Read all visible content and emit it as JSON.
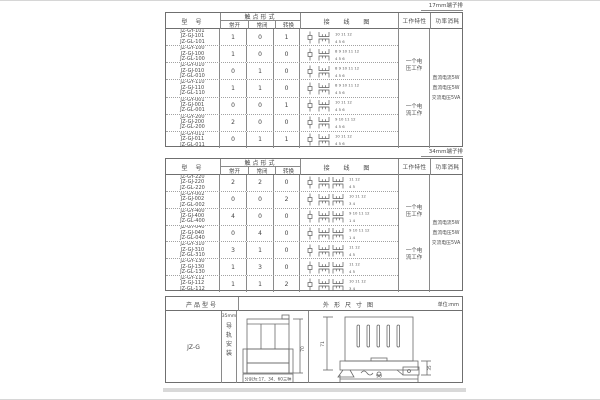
{
  "labels": {
    "t1": "17mm端子排",
    "t2": "34mm端子排"
  },
  "headers": {
    "model": "型 号",
    "contact": "触点形式",
    "no": "常开",
    "nc": "常闭",
    "co": "转换",
    "wiring": "接 线 图",
    "work": "工作特性",
    "power": "功率消耗"
  },
  "common": {
    "work_notes": [
      "一个电压工作",
      "一个电流工作"
    ],
    "power_notes": [
      "直流电流5W",
      "直流电压5W",
      "交流电压5VA"
    ]
  },
  "table1": {
    "rows": [
      {
        "models": [
          "JZ-GY-101",
          "JZ-GJ-101",
          "JZ-GL-101"
        ],
        "no": "1",
        "nc": "0",
        "co": "1",
        "top": "10 11 12",
        "bot": "4 5 6"
      },
      {
        "models": [
          "JZ-GY-100",
          "JZ-GJ-100",
          "JZ-GL-100"
        ],
        "no": "1",
        "nc": "0",
        "co": "0",
        "top": "8 9 10 11 12",
        "bot": "4 5 6"
      },
      {
        "models": [
          "JZ-GY-010",
          "JZ-GJ-010",
          "JZ-GL-010"
        ],
        "no": "0",
        "nc": "1",
        "co": "0",
        "top": "8 9 10 11 12",
        "bot": "4 5 6"
      },
      {
        "models": [
          "JZ-GY-110",
          "JZ-GJ-110",
          "JZ-GL-110"
        ],
        "no": "1",
        "nc": "1",
        "co": "0",
        "top": "8 9 10 11 12",
        "bot": "4 5 6"
      },
      {
        "models": [
          "JZ-GY-001",
          "JZ-GJ-001",
          "JZ-GL-001"
        ],
        "no": "0",
        "nc": "0",
        "co": "1",
        "top": "10 11 12",
        "bot": "4 5 6"
      },
      {
        "models": [
          "JZ-GY-200",
          "JZ-GJ-200",
          "JZ-GL-200"
        ],
        "no": "2",
        "nc": "0",
        "co": "0",
        "top": "9 10 11 12",
        "bot": "4 5 6"
      },
      {
        "models": [
          "JZ-GY-011",
          "JZ-GJ-011",
          "JZ-GL-011"
        ],
        "no": "0",
        "nc": "1",
        "co": "1",
        "top": "10 11 12",
        "bot": "4 5 6"
      }
    ]
  },
  "table2": {
    "rows": [
      {
        "models": [
          "JZ-GY-220",
          "JZ-GJ-220",
          "JZ-GL-220"
        ],
        "no": "2",
        "nc": "2",
        "co": "0",
        "top": "11 12",
        "bot": "4 5"
      },
      {
        "models": [
          "JZ-GY-002",
          "JZ-GJ-002",
          "JZ-GL-002"
        ],
        "no": "0",
        "nc": "0",
        "co": "2",
        "top": "10 11 12",
        "bot": "3 4"
      },
      {
        "models": [
          "JZ-GY-400",
          "JZ-GJ-400",
          "JZ-GL-400"
        ],
        "no": "4",
        "nc": "0",
        "co": "0",
        "top": "9 10 11 12",
        "bot": "1 4"
      },
      {
        "models": [
          "JZ-GY-040",
          "JZ-GJ-040",
          "JZ-GL-040"
        ],
        "no": "0",
        "nc": "4",
        "co": "0",
        "top": "9 10 11 12",
        "bot": "1 4"
      },
      {
        "models": [
          "JZ-GY-310",
          "JZ-GJ-310",
          "JZ-GL-310"
        ],
        "no": "3",
        "nc": "1",
        "co": "0",
        "top": "11 12",
        "bot": "4 5"
      },
      {
        "models": [
          "JZ-GY-130",
          "JZ-GJ-130",
          "JZ-GL-130"
        ],
        "no": "1",
        "nc": "3",
        "co": "0",
        "top": "11 12",
        "bot": "4 5"
      },
      {
        "models": [
          "JZ-GY-112",
          "JZ-GJ-112",
          "JZ-GL-112"
        ],
        "no": "1",
        "nc": "1",
        "co": "2",
        "top": "10 11 12",
        "bot": "3 4"
      }
    ]
  },
  "table3": {
    "header_model": "产品型号",
    "header_drawing": "外形尺寸图",
    "unit": "单位:mm",
    "model": "JZ-G",
    "mount_top": "35mm",
    "mount_vert": "导轨安装",
    "front_note": "分别为:17、34、60三种",
    "front_height": "70",
    "side_height": "71",
    "side_width": "90",
    "rail_width": "35"
  }
}
